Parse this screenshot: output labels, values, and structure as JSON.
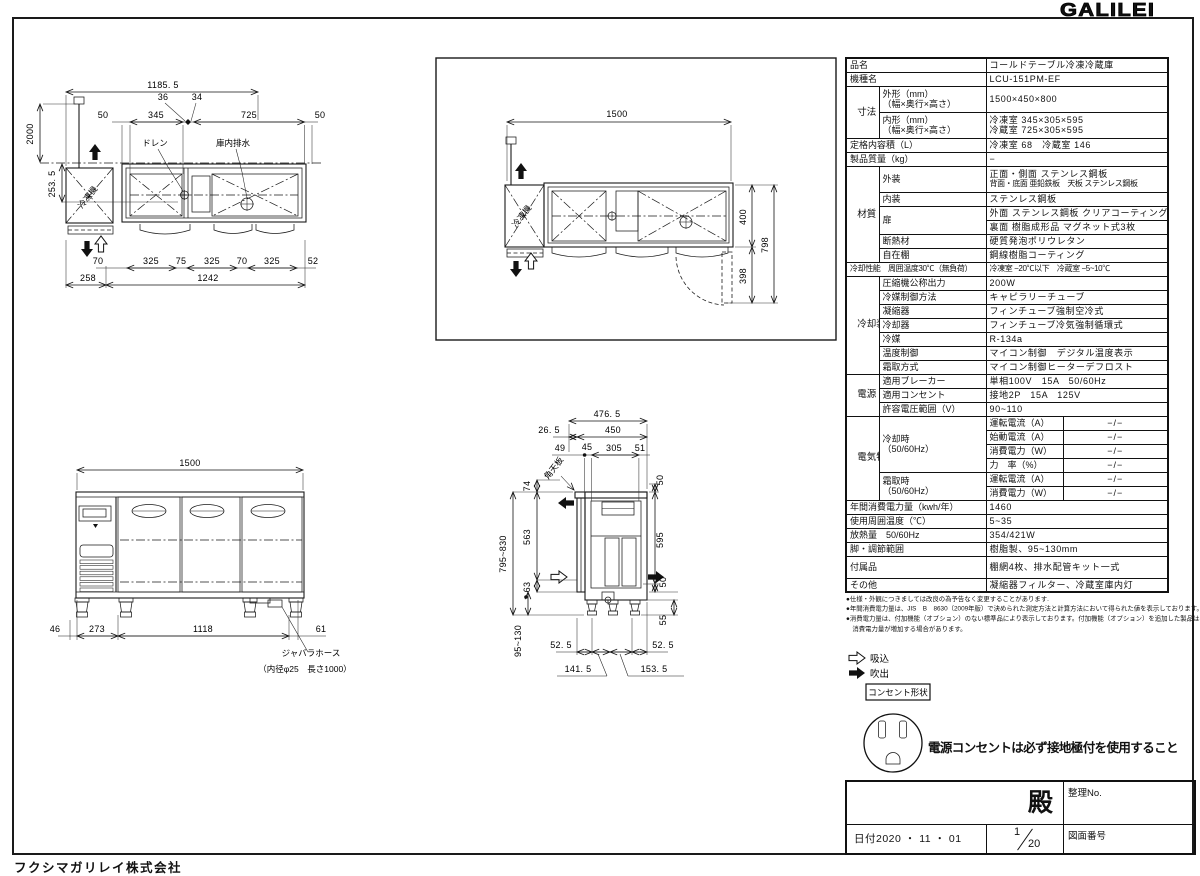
{
  "header": {
    "logo": "GALILEI",
    "company": "フクシマガリレイ株式会社"
  },
  "spec": {
    "hinmei_l": "品名",
    "hinmei": "コールドテーブル冷凍冷蔵庫",
    "kishu_l": "機種名",
    "kishu": "LCU-151PM-EF",
    "cat_sunpo": "寸法",
    "gaikei_l1": "外形（mm）",
    "gaikei_l2": "（幅×奥行×高さ）",
    "gaikei_v": "1500×450×800",
    "naikei_l1": "内形（mm）",
    "naikei_l2": "（幅×奥行×高さ）",
    "naikei_v1": "冷凍室 345×305×595",
    "naikei_v2": "冷蔵室 725×305×595",
    "teikaku_l": "定格内容積（L）",
    "teikaku_v": "冷凍室 68　冷蔵室 146",
    "shitsuryo_l": "製品質量（kg）",
    "shitsuryo_v": "−",
    "cat_zai": "材質",
    "gaiso_l": "外装",
    "gaiso_v1": "正面・側面 ステンレス鋼板",
    "gaiso_v2": "背面・底面 亜鉛鉄板　天板 ステンレス鋼板",
    "naiso_l": "内装",
    "naiso_v": "ステンレス鋼板",
    "tobira_l": "扉",
    "tobira_v1": "外面 ステンレス鋼板 クリアコーティング",
    "tobira_v2": "裏面 樹脂成形品 マグネット式3枚",
    "dannetsu_l": "断熱材",
    "dannetsu_v": "硬質発泡ポリウレタン",
    "jizai_l": "自在棚",
    "jizai_v": "鋼線樹脂コーティング",
    "seino_l": "冷却性能　周囲温度30℃（無負荷）",
    "seino_v": "冷凍室 −20℃以下　冷蔵室 −5~10℃",
    "cat_rei": "冷却装置",
    "asshuku_l": "圧縮機公称出力",
    "asshuku_v": "200W",
    "reibaisei_l": "冷媒制御方法",
    "reibaisei_v": "キャピラリーチューブ",
    "gyoshuku_l": "凝縮器",
    "gyoshuku_v": "フィンチューブ強制空冷式",
    "reikyakuki_l": "冷却器",
    "reikyakuki_v": "フィンチューブ冷気強制循環式",
    "reibai_l": "冷媒",
    "reibai_v": "R-134a",
    "ondo_l": "温度制御",
    "ondo_v": "マイコン制御　デジタル温度表示",
    "shimotori_l": "霜取方式",
    "shimotori_v": "マイコン制御ヒーターデフロスト",
    "cat_dengen": "電源",
    "breaker_l": "適用ブレーカー",
    "breaker_v": "単相100V　15A　50/60Hz",
    "consent_l": "適用コンセント",
    "consent_v": "接地2P　15A　125V",
    "denatsu_l": "許容電圧範囲（V）",
    "denatsu_v": "90~110",
    "cat_denki": "電気特性",
    "nenkan_l": "年間消費電力量（kwh/年）",
    "nenkan_v": "1460",
    "shuui_l": "使用周囲温度（℃）",
    "shuui_v": "5~35",
    "hounetsu_l": "放熱量　50/60Hz",
    "hounetsu_v": "354/421W",
    "ashi_l": "脚・調節範囲",
    "ashi_v": "樹脂製、95~130mm",
    "fuzoku_l": "付属品",
    "fuzoku_v": "棚網4枚、排水配管キット一式",
    "sonota_l": "その他",
    "sonota_v": "凝縮器フィルター、冷蔵室庫内灯"
  },
  "elec": {
    "reikyakuji": "冷却時",
    "reikyakuji2": "（50/60Hz）",
    "shimotoriji": "霜取時",
    "shimotoriji2": "（50/60Hz）",
    "unten": "運転電流（A）",
    "shido": "始動電流（A）",
    "shohi": "消費電力（W）",
    "riki": "力　率（%）",
    "val": "−/−"
  },
  "notes": {
    "n1": "●仕様・外観につきましては改良の為予告なく変更することがあります.",
    "n2": "●年間消費電力量は、JIS　B　8630（2009年版）で決められた測定方法と計算方法において得られた値を表示しております。",
    "n3": "●消費電力量は、付加機能（オプション）のない標準品により表示しております。付加機能（オプション）を追加した製品は、",
    "n4": "　消費電力量が増加する場合があります。"
  },
  "legend": {
    "suikomi": "吸込",
    "fukidashi": "吹出",
    "consent": "コンセント形状",
    "warning": "電源コンセントは必ず接地極付を使用すること"
  },
  "title_block": {
    "dono": "殿",
    "seiri_no": "整理No.",
    "date": "日付2020 ・ 11 ・ 01",
    "sheet_num": "1",
    "sheet_den": "20",
    "zumen_no": "図面番号"
  },
  "plan": {
    "total": "1185. 5",
    "w36": "36",
    "w34": "34",
    "w50l": "50",
    "w345": "345",
    "w725": "725",
    "w50r": "50",
    "h2000": "2000",
    "h2535": "253. 5",
    "b70a": "70",
    "b325a": "325",
    "b75": "75",
    "b325b": "325",
    "b70b": "70",
    "b325c": "325",
    "b52": "52",
    "b258": "258",
    "b1242": "1242",
    "drain": "ドレン",
    "naibu": "庫内排水",
    "reitoki": "冷凍機"
  },
  "top": {
    "w1500": "1500",
    "h400": "400",
    "h398": "398",
    "h798": "798",
    "reitoki": "冷凍機"
  },
  "front": {
    "w1500": "1500",
    "b46": "46",
    "b273": "273",
    "b1118": "1118",
    "b61": "61",
    "hose1": "ジャバラホース",
    "hose2": "（内径φ25　長さ1000）"
  },
  "side": {
    "t4765": "476. 5",
    "t265": "26. 5",
    "t450": "450",
    "t49": "49",
    "t45": "45",
    "t305": "305",
    "t51": "51",
    "l74": "74",
    "l563": "563",
    "l63": "63",
    "l795": "795~830",
    "l95": "95~130",
    "r50a": "50",
    "r595": "595",
    "r50b": "50",
    "r55": "55",
    "b525a": "52. 5",
    "b525b": "52. 5",
    "b1415": "141. 5",
    "b1535": "153. 5",
    "tenban": "角天板"
  }
}
